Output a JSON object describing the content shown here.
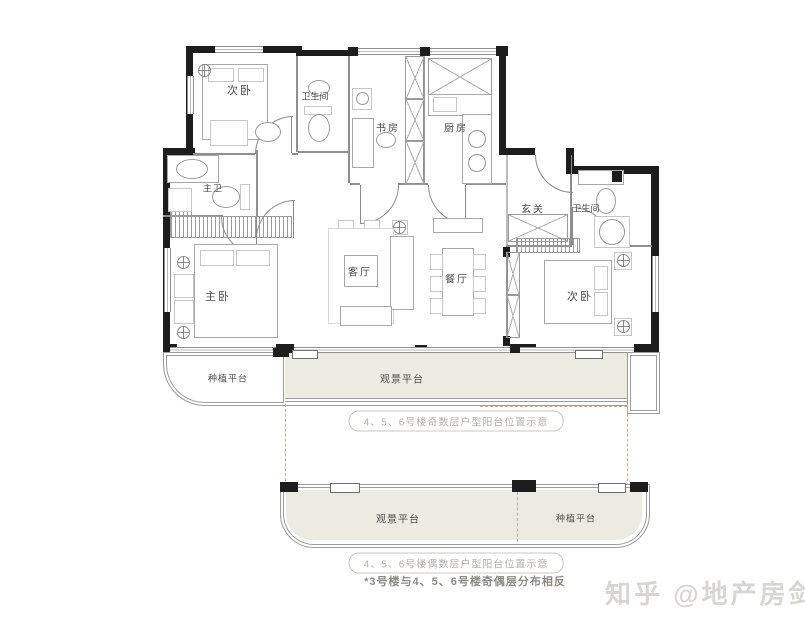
{
  "rooms": {
    "bedroom_top": "次卧",
    "bath_top": "卫生间",
    "study": "书房",
    "kitchen": "厨房",
    "master_bath": "主卫",
    "foyer": "玄关",
    "bath_right": "卫生间",
    "living": "客厅",
    "dining": "餐厅",
    "master_bedroom": "主卧",
    "bedroom_right": "次卧"
  },
  "platforms": {
    "planting_upper": "种植平台",
    "viewing_upper": "观景平台",
    "viewing_lower": "观景平台",
    "planting_lower": "种植平台"
  },
  "captions": {
    "odd": "4、5、6号楼奇数层户型阳台位置示意",
    "even": "4、5、6号楼偶数层户型阳台位置示意",
    "note": "*3号楼与4、5、6号楼奇偶层分布相反"
  },
  "watermark": "知乎 @地产房剑",
  "colors": {
    "wall": "#1d1d1d",
    "platform_fill": "#edeae1",
    "dashed_alt_balcony": "#cfa98c",
    "caption_text": "#b7b2ab",
    "note_text": "#8e8982",
    "watermark_text": "#d8d5d2"
  }
}
